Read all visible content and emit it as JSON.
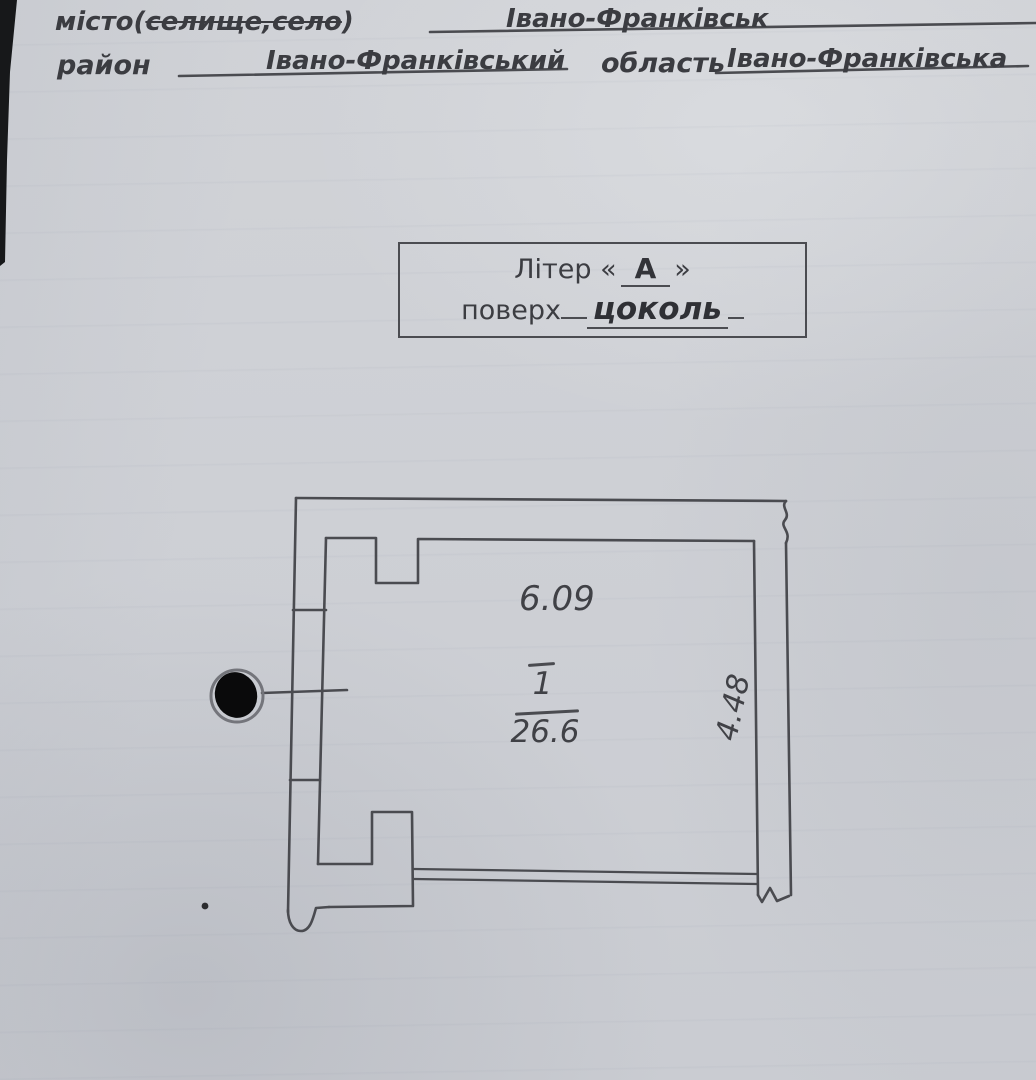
{
  "header": {
    "line1": {
      "label_prefix": "місто(",
      "label_struck": "селище,село",
      "label_suffix": ")",
      "value": "Івано-Франківськ"
    },
    "line2": {
      "district_label": "район",
      "district_value": "Івано-Франківський",
      "region_label": "область",
      "region_value": "Івано-Франківська"
    }
  },
  "letter_box": {
    "line1_prefix": "Літер «",
    "letter": "А",
    "line1_suffix": "»",
    "floor_label": "поверх",
    "floor_value": "цоколь"
  },
  "plan": {
    "width_dimension": "6.09",
    "height_dimension": "4.48",
    "room_number": "1",
    "room_area": "26.6"
  },
  "icons": {
    "seal": "filled-circle-marker"
  },
  "colors": {
    "paper": "#cfd1d6",
    "ink": "#3b3c41",
    "line": "#4a4b50",
    "seal_fill": "#0a0a0b"
  }
}
